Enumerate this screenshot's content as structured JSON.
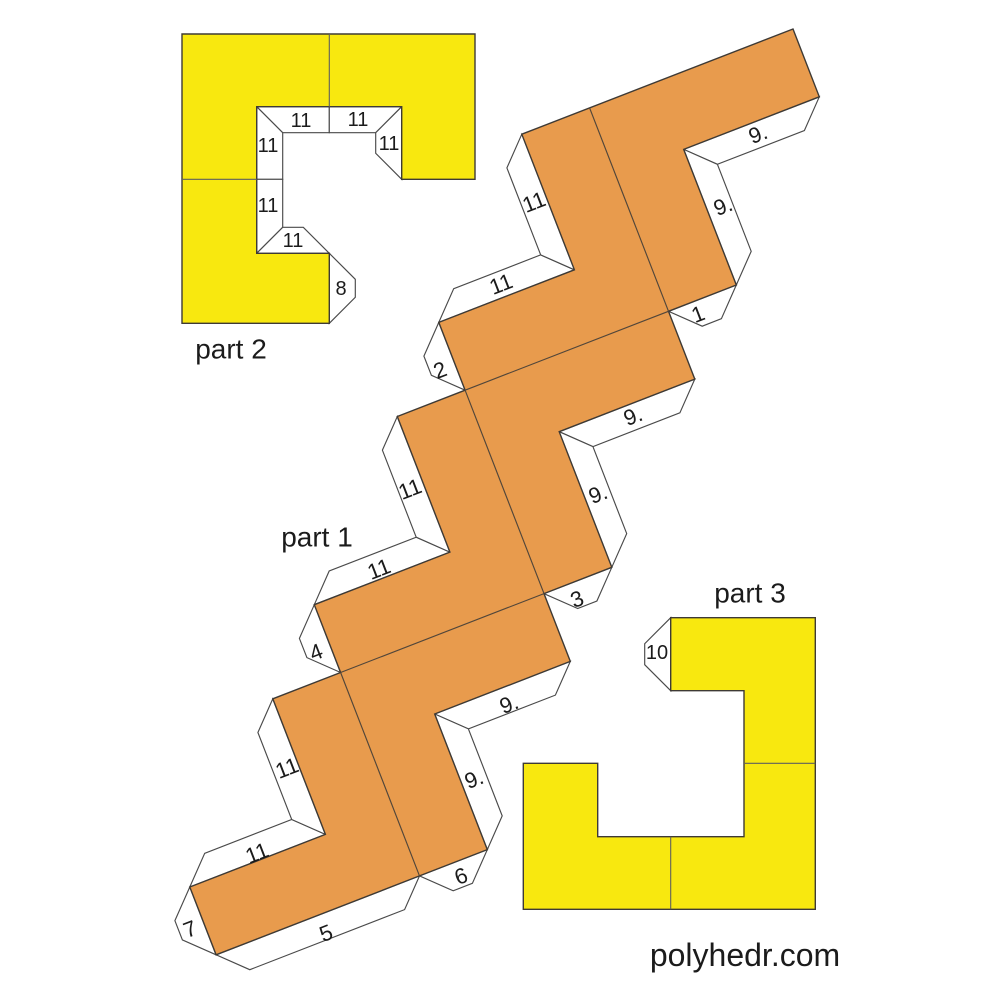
{
  "colors": {
    "part1_fill": "#E89B4D",
    "part23_fill": "#F8E80F",
    "tab_fill": "#FFFFFF"
  },
  "part1": {
    "title": "part 1",
    "tab_labels": [
      "9.",
      "9.",
      "1",
      "9.",
      "9.",
      "3",
      "9.",
      "9.",
      "6",
      "5",
      "7",
      "11",
      "11",
      "4",
      "11",
      "11",
      "2",
      "11",
      "11"
    ]
  },
  "part2": {
    "title": "part 2",
    "tab_labels": [
      "11",
      "11",
      "11",
      "11",
      "11",
      "11",
      "8"
    ]
  },
  "part3": {
    "title": "part 3",
    "tab_labels": [
      "10"
    ]
  },
  "footer": {
    "watermark": "polyhedr.com"
  }
}
